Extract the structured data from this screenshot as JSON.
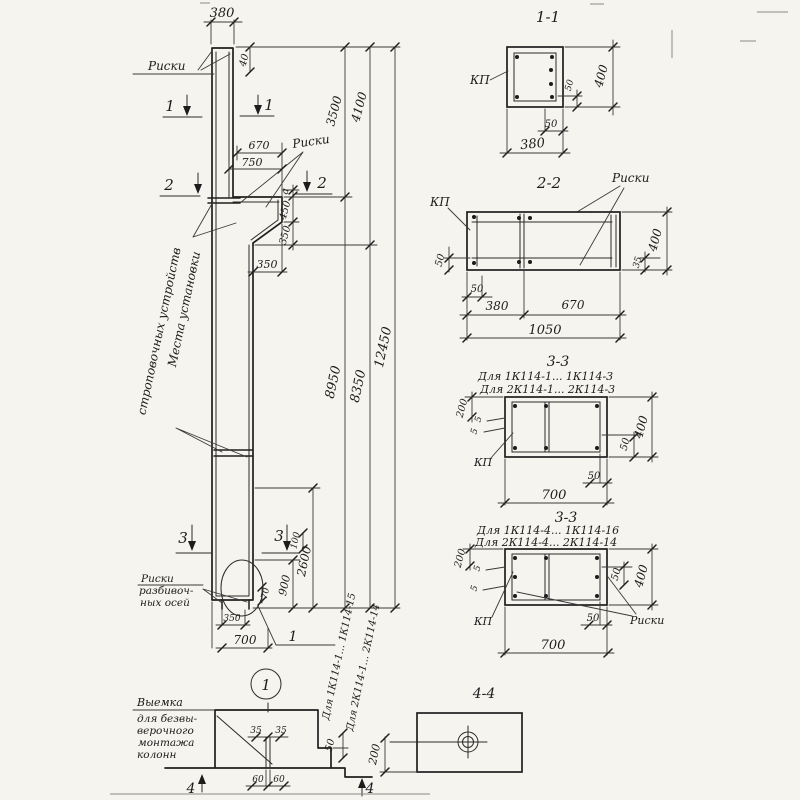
{
  "main": {
    "dim_380": "380",
    "dim_40": "40",
    "riski_top": "Риски",
    "riski_mid": "Риски",
    "dim_670": "670",
    "dim_750": "750",
    "dim_a": "а",
    "dim_450": "450",
    "dim_350v": "350",
    "dim_350h": "350",
    "sling1": "Места установки",
    "sling2": "строповочных устройств",
    "d3500": "3500",
    "d4100": "4100",
    "d8950": "8950",
    "d8350": "8350",
    "d12450": "12450",
    "d100": "100",
    "d2600": "2600",
    "d900": "900",
    "d70": "70",
    "d350b": "350",
    "d700": "700",
    "axes1": "Риски",
    "axes2": "разбивоч-",
    "axes3": "ных осей",
    "detail_ref": "1",
    "series1": "Для 1К114-1... 1К114-15",
    "series2": "Для 2К114-1... 2К114-14",
    "m1": "1",
    "m2": "2",
    "m3": "3",
    "m4": "4"
  },
  "s11": {
    "title": "1-1",
    "kp": "КП",
    "d400": "400",
    "d50a": "50",
    "d50b": "50",
    "d380": "380"
  },
  "s22": {
    "title": "2-2",
    "kp": "КП",
    "riski": "Риски",
    "d50l": "50",
    "d50b": "50",
    "d380": "380",
    "d670": "670",
    "d1050": "1050",
    "d400": "400",
    "d35": "35"
  },
  "s33a": {
    "title": "3-3",
    "for1": "Для 1К114-1... 1К114-3",
    "for2": "Для 2К114-1... 2К114-3",
    "kp": "КП",
    "d200": "200",
    "d5a": "5",
    "d5b": "5",
    "d50r": "50",
    "d400": "400",
    "d50b": "50",
    "d700": "700"
  },
  "s33b": {
    "title": "3-3",
    "for1": "Для 1К114-4... 1К114-16",
    "for2": "Для 2К114-4... 2К114-14",
    "kp": "КП",
    "riski": "Риски",
    "d200": "200",
    "d5a": "5",
    "d5b": "5",
    "d50r": "50",
    "d400": "400",
    "d50b": "50",
    "d700": "700"
  },
  "s44": {
    "title": "4-4",
    "d200": "200"
  },
  "recess": {
    "t1": "Выемка",
    "t2": "для безвы-",
    "t3": "верочного",
    "t4": "монтажа",
    "t5": "колонн",
    "d35a": "35",
    "d35b": "35",
    "d60a": "60",
    "d60b": "60",
    "d50": "50"
  }
}
